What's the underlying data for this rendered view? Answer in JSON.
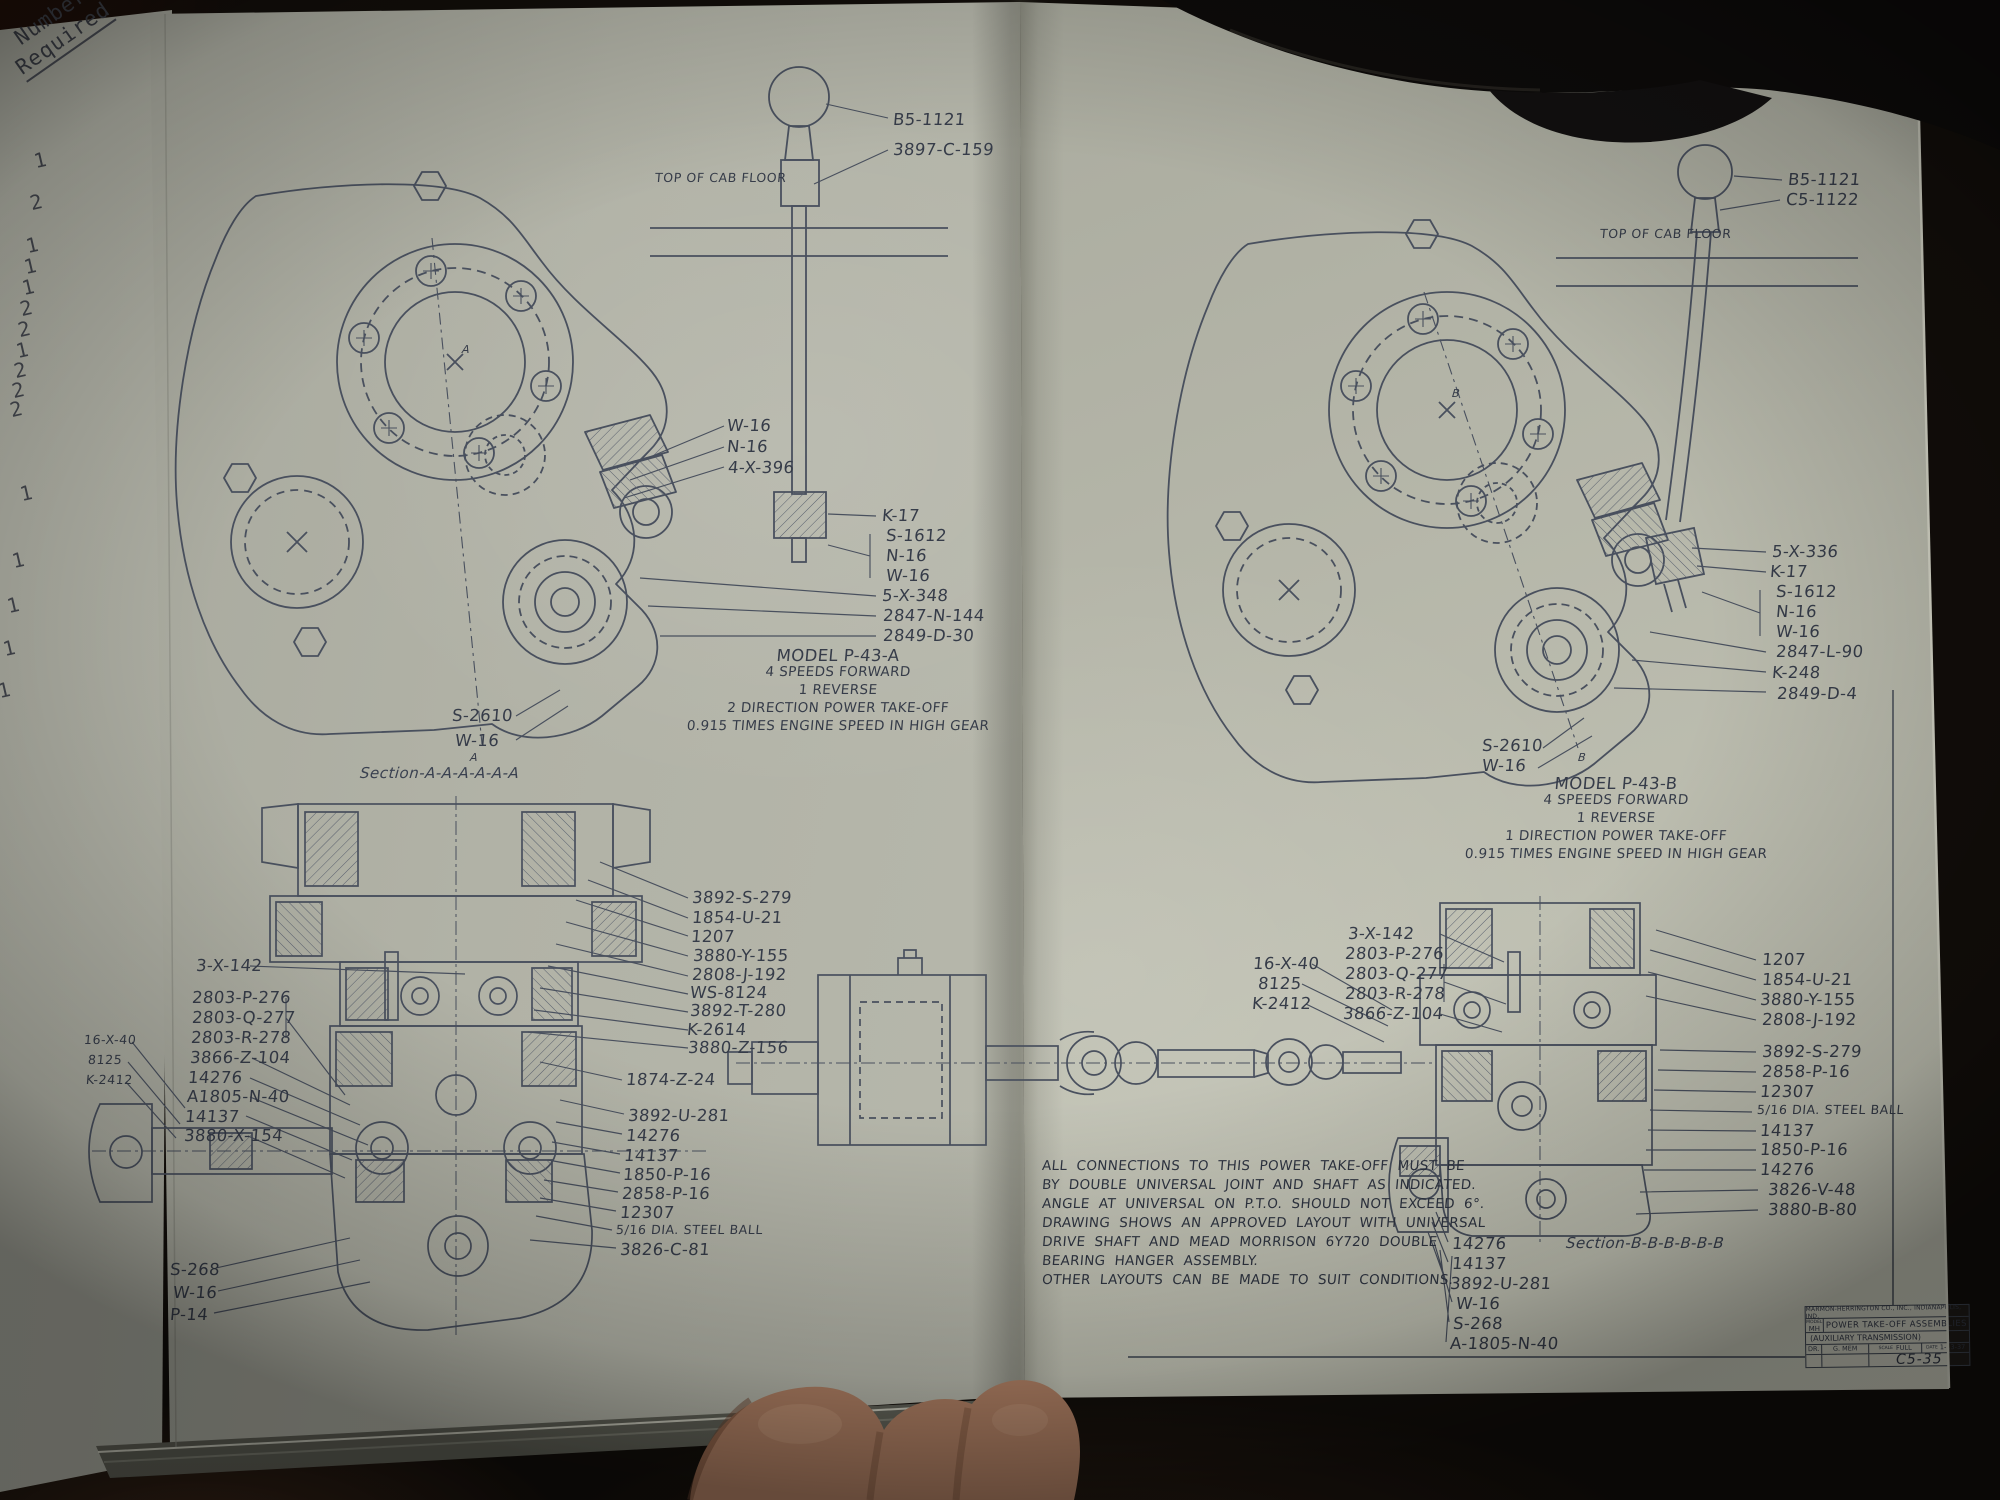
{
  "colors": {
    "page": "#b2b3a7",
    "ink": "#49505e",
    "text": "#363c49",
    "background": "#120e0a",
    "hand": "#b08064"
  },
  "margin": {
    "header_line1": "Number",
    "header_line2": "Required",
    "numbers": [
      {
        "t": "1",
        "x": 34,
        "y": 150,
        "c": "type",
        "n": "quantity-number"
      },
      {
        "t": "2",
        "x": 30,
        "y": 192,
        "c": "type",
        "n": "quantity-number"
      },
      {
        "t": "1",
        "x": 26,
        "y": 235,
        "c": "type",
        "n": "quantity-number"
      },
      {
        "t": "1",
        "x": 24,
        "y": 256,
        "c": "type",
        "n": "quantity-number"
      },
      {
        "t": "1",
        "x": 22,
        "y": 277,
        "c": "type",
        "n": "quantity-number"
      },
      {
        "t": "2",
        "x": 20,
        "y": 298,
        "c": "type",
        "n": "quantity-number"
      },
      {
        "t": "2",
        "x": 18,
        "y": 319,
        "c": "type",
        "n": "quantity-number"
      },
      {
        "t": "1",
        "x": 16,
        "y": 340,
        "c": "type",
        "n": "quantity-number"
      },
      {
        "t": "2",
        "x": 14,
        "y": 360,
        "c": "type",
        "n": "quantity-number"
      },
      {
        "t": "2",
        "x": 12,
        "y": 380,
        "c": "type",
        "n": "quantity-number"
      },
      {
        "t": "2",
        "x": 10,
        "y": 399,
        "c": "type",
        "n": "quantity-number"
      },
      {
        "t": "1",
        "x": 20,
        "y": 483,
        "c": "type",
        "n": "quantity-number"
      },
      {
        "t": "1",
        "x": 12,
        "y": 550,
        "c": "type",
        "n": "quantity-number"
      },
      {
        "t": "1",
        "x": 7,
        "y": 595,
        "c": "type",
        "n": "quantity-number"
      },
      {
        "t": "1",
        "x": 3,
        "y": 638,
        "c": "type",
        "n": "quantity-number"
      },
      {
        "t": "1",
        "x": -2,
        "y": 680,
        "c": "type",
        "n": "quantity-number"
      }
    ]
  },
  "left_assembly": {
    "labels": [
      {
        "t": "B5-1121",
        "x": 893,
        "y": 112
      },
      {
        "t": "3897-C-159",
        "x": 893,
        "y": 142
      },
      {
        "t": "TOP OF CAB FLOOR",
        "x": 655,
        "y": 172,
        "c": "sm",
        "n": "floor-label"
      },
      {
        "t": "W-16",
        "x": 727,
        "y": 418
      },
      {
        "t": "N-16",
        "x": 727,
        "y": 439
      },
      {
        "t": "4-X-396",
        "x": 728,
        "y": 460
      },
      {
        "t": "K-17",
        "x": 882,
        "y": 508
      },
      {
        "t": "S-1612",
        "x": 886,
        "y": 528
      },
      {
        "t": "N-16",
        "x": 886,
        "y": 548
      },
      {
        "t": "W-16",
        "x": 886,
        "y": 568
      },
      {
        "t": "5-X-348",
        "x": 882,
        "y": 588
      },
      {
        "t": "2847-N-144",
        "x": 883,
        "y": 608
      },
      {
        "t": "2849-D-30",
        "x": 883,
        "y": 628
      },
      {
        "t": "S-2610",
        "x": 452,
        "y": 708
      },
      {
        "t": "W-16",
        "x": 455,
        "y": 733
      },
      {
        "t": "MODEL P-43-A",
        "x": 838,
        "y": 648,
        "c": "ctr",
        "n": "model-title"
      },
      {
        "t": "4 SPEEDS FORWARD",
        "x": 838,
        "y": 666,
        "c": "ctr sm2",
        "n": "model-spec"
      },
      {
        "t": "1 REVERSE",
        "x": 838,
        "y": 684,
        "c": "ctr sm2",
        "n": "model-spec"
      },
      {
        "t": "2 DIRECTION POWER TAKE-OFF",
        "x": 838,
        "y": 702,
        "c": "ctr sm2",
        "n": "model-spec"
      },
      {
        "t": "0.915 TIMES ENGINE SPEED IN HIGH GEAR",
        "x": 838,
        "y": 720,
        "c": "ctr sm2",
        "n": "model-spec"
      },
      {
        "t": "A",
        "x": 462,
        "y": 344,
        "c": "tin",
        "n": "section-letter"
      },
      {
        "t": "A",
        "x": 470,
        "y": 752,
        "c": "tin",
        "n": "section-letter"
      }
    ]
  },
  "left_section": {
    "labels": [
      {
        "t": "Section-A-A-A-A-A-A",
        "x": 360,
        "y": 766,
        "c": "cap",
        "n": "section-caption"
      },
      {
        "t": "3892-S-279",
        "x": 692,
        "y": 890
      },
      {
        "t": "1854-U-21",
        "x": 692,
        "y": 910
      },
      {
        "t": "1207",
        "x": 691,
        "y": 929
      },
      {
        "t": "3880-Y-155",
        "x": 693,
        "y": 948
      },
      {
        "t": "2808-J-192",
        "x": 692,
        "y": 967
      },
      {
        "t": "WS-8124",
        "x": 690,
        "y": 985
      },
      {
        "t": "3892-T-280",
        "x": 690,
        "y": 1003
      },
      {
        "t": "K-2614",
        "x": 687,
        "y": 1022
      },
      {
        "t": "3880-Z-156",
        "x": 688,
        "y": 1040
      },
      {
        "t": "1874-Z-24",
        "x": 626,
        "y": 1072
      },
      {
        "t": "3892-U-281",
        "x": 628,
        "y": 1108
      },
      {
        "t": "14276",
        "x": 626,
        "y": 1128
      },
      {
        "t": "14137",
        "x": 624,
        "y": 1148
      },
      {
        "t": "1850-P-16",
        "x": 623,
        "y": 1167
      },
      {
        "t": "2858-P-16",
        "x": 622,
        "y": 1186
      },
      {
        "t": "12307",
        "x": 620,
        "y": 1205
      },
      {
        "t": "5/16 DIA. STEEL BALL",
        "x": 616,
        "y": 1224,
        "c": "sm"
      },
      {
        "t": "3826-C-81",
        "x": 620,
        "y": 1242
      },
      {
        "t": "3-X-142",
        "x": 196,
        "y": 958
      },
      {
        "t": "2803-P-276",
        "x": 192,
        "y": 990
      },
      {
        "t": "2803-Q-277",
        "x": 192,
        "y": 1010
      },
      {
        "t": "2803-R-278",
        "x": 191,
        "y": 1030
      },
      {
        "t": "3866-Z-104",
        "x": 190,
        "y": 1050
      },
      {
        "t": "14276",
        "x": 188,
        "y": 1070
      },
      {
        "t": "A1805-N-40",
        "x": 187,
        "y": 1089
      },
      {
        "t": "14137",
        "x": 185,
        "y": 1109
      },
      {
        "t": "3880-X-154",
        "x": 184,
        "y": 1128
      },
      {
        "t": "16-X-40",
        "x": 84,
        "y": 1034,
        "c": "sm"
      },
      {
        "t": "8125",
        "x": 88,
        "y": 1054,
        "c": "sm"
      },
      {
        "t": "K-2412",
        "x": 86,
        "y": 1074,
        "c": "sm"
      },
      {
        "t": "S-268",
        "x": 170,
        "y": 1262
      },
      {
        "t": "W-16",
        "x": 173,
        "y": 1285
      },
      {
        "t": "P-14",
        "x": 170,
        "y": 1307
      }
    ]
  },
  "right_assembly": {
    "labels": [
      {
        "t": "B5-1121",
        "x": 1788,
        "y": 172
      },
      {
        "t": "C5-1122",
        "x": 1786,
        "y": 192
      },
      {
        "t": "TOP OF CAB FLOOR",
        "x": 1600,
        "y": 228,
        "c": "sm",
        "n": "floor-label"
      },
      {
        "t": "5-X-336",
        "x": 1772,
        "y": 544
      },
      {
        "t": "K-17",
        "x": 1770,
        "y": 564
      },
      {
        "t": "S-1612",
        "x": 1776,
        "y": 584
      },
      {
        "t": "N-16",
        "x": 1776,
        "y": 604
      },
      {
        "t": "W-16",
        "x": 1776,
        "y": 624
      },
      {
        "t": "2847-L-90",
        "x": 1776,
        "y": 644
      },
      {
        "t": "K-248",
        "x": 1772,
        "y": 665
      },
      {
        "t": "2849-D-4",
        "x": 1777,
        "y": 686
      },
      {
        "t": "S-2610",
        "x": 1482,
        "y": 738
      },
      {
        "t": "W-16",
        "x": 1482,
        "y": 758
      },
      {
        "t": "MODEL P-43-B",
        "x": 1616,
        "y": 776,
        "c": "ctr",
        "n": "model-title"
      },
      {
        "t": "4 SPEEDS FORWARD",
        "x": 1616,
        "y": 794,
        "c": "ctr sm2",
        "n": "model-spec"
      },
      {
        "t": "1 REVERSE",
        "x": 1616,
        "y": 812,
        "c": "ctr sm2",
        "n": "model-spec"
      },
      {
        "t": "1 DIRECTION POWER TAKE-OFF",
        "x": 1616,
        "y": 830,
        "c": "ctr sm2",
        "n": "model-spec"
      },
      {
        "t": "0.915 TIMES ENGINE SPEED IN HIGH GEAR",
        "x": 1616,
        "y": 848,
        "c": "ctr sm2",
        "n": "model-spec"
      },
      {
        "t": "B",
        "x": 1452,
        "y": 388,
        "c": "tin",
        "n": "section-letter"
      },
      {
        "t": "B",
        "x": 1578,
        "y": 752,
        "c": "tin",
        "n": "section-letter"
      }
    ]
  },
  "right_section": {
    "labels": [
      {
        "t": "3-X-142",
        "x": 1348,
        "y": 926
      },
      {
        "t": "2803-P-276",
        "x": 1345,
        "y": 946
      },
      {
        "t": "2803-Q-277",
        "x": 1345,
        "y": 966
      },
      {
        "t": "2803-R-278",
        "x": 1345,
        "y": 986
      },
      {
        "t": "3866-Z-104",
        "x": 1343,
        "y": 1006
      },
      {
        "t": "16-X-40",
        "x": 1253,
        "y": 956
      },
      {
        "t": "8125",
        "x": 1258,
        "y": 976
      },
      {
        "t": "K-2412",
        "x": 1252,
        "y": 996
      },
      {
        "t": "1207",
        "x": 1762,
        "y": 952
      },
      {
        "t": "1854-U-21",
        "x": 1762,
        "y": 972
      },
      {
        "t": "3880-Y-155",
        "x": 1760,
        "y": 992
      },
      {
        "t": "2808-J-192",
        "x": 1762,
        "y": 1012
      },
      {
        "t": "3892-S-279",
        "x": 1762,
        "y": 1044
      },
      {
        "t": "2858-P-16",
        "x": 1762,
        "y": 1064
      },
      {
        "t": "12307",
        "x": 1760,
        "y": 1084
      },
      {
        "t": "5/16 DIA. STEEL BALL",
        "x": 1757,
        "y": 1104,
        "c": "sm"
      },
      {
        "t": "14137",
        "x": 1760,
        "y": 1123
      },
      {
        "t": "1850-P-16",
        "x": 1760,
        "y": 1142
      },
      {
        "t": "14276",
        "x": 1760,
        "y": 1162
      },
      {
        "t": "3826-V-48",
        "x": 1768,
        "y": 1182
      },
      {
        "t": "3880-B-80",
        "x": 1768,
        "y": 1202
      },
      {
        "t": "14276",
        "x": 1452,
        "y": 1236
      },
      {
        "t": "14137",
        "x": 1452,
        "y": 1256
      },
      {
        "t": "3892-U-281",
        "x": 1450,
        "y": 1276
      },
      {
        "t": "W-16",
        "x": 1456,
        "y": 1296
      },
      {
        "t": "S-268",
        "x": 1453,
        "y": 1316
      },
      {
        "t": "A-1805-N-40",
        "x": 1450,
        "y": 1336
      },
      {
        "t": "Section-B-B-B-B-B-B",
        "x": 1566,
        "y": 1236,
        "c": "cap",
        "n": "section-caption"
      }
    ]
  },
  "note": {
    "labels": [
      {
        "t": "ALL CONNECTIONS TO THIS POWER TAKE-OFF MUST BE",
        "x": 1042,
        "y": 1160,
        "c": "note",
        "n": "note-line"
      },
      {
        "t": "BY DOUBLE UNIVERSAL JOINT AND SHAFT AS INDICATED.",
        "x": 1042,
        "y": 1179,
        "c": "note",
        "n": "note-line"
      },
      {
        "t": "ANGLE AT UNIVERSAL ON P.T.O. SHOULD NOT EXCEED 6°.",
        "x": 1042,
        "y": 1198,
        "c": "note",
        "n": "note-line"
      },
      {
        "t": "DRAWING SHOWS AN APPROVED LAYOUT WITH UNIVERSAL",
        "x": 1042,
        "y": 1217,
        "c": "note",
        "n": "note-line"
      },
      {
        "t": "DRIVE SHAFT AND MEAD MORRISON 6Y720 DOUBLE",
        "x": 1042,
        "y": 1236,
        "c": "note",
        "n": "note-line"
      },
      {
        "t": "BEARING HANGER ASSEMBLY.",
        "x": 1042,
        "y": 1255,
        "c": "note",
        "n": "note-line"
      },
      {
        "t": "OTHER LAYOUTS CAN BE MADE TO SUIT CONDITIONS.",
        "x": 1042,
        "y": 1274,
        "c": "note",
        "n": "note-line"
      }
    ]
  },
  "title_block": {
    "company": "MARMON-HERRINGTON CO., INC., INDIANAPOLIS, IND.",
    "model_label": "MODEL",
    "code": "MH",
    "title": "POWER TAKE-OFF ASSEMBLIES",
    "subtitle": "(AUXILIARY TRANSMISSION)",
    "dr_label": "DR.",
    "drafter": "G. MEM",
    "scale_label": "SCALE",
    "scale": "FULL",
    "date_label": "DATE",
    "date": "1-13-37",
    "sheet_no": "C5-35"
  }
}
